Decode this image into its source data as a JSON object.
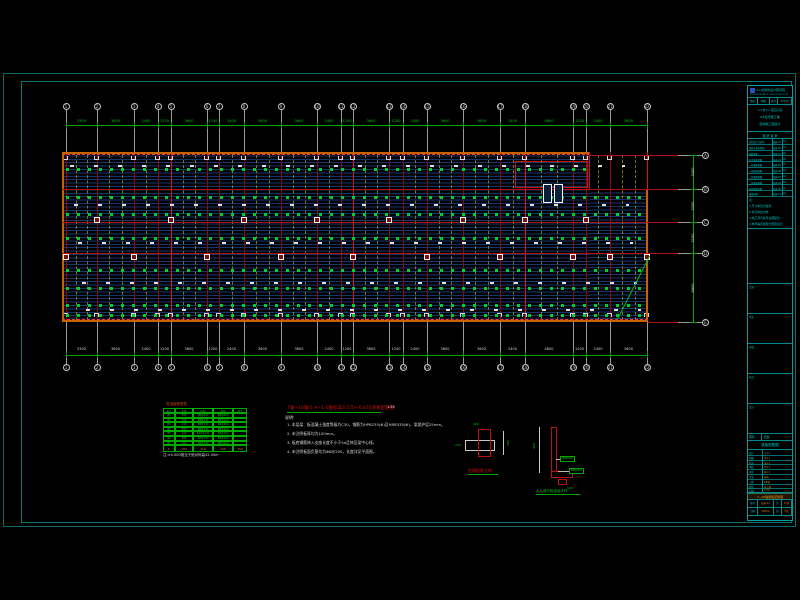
{
  "colors": {
    "background": "#000000",
    "frame_teal": "#0c6868",
    "titleblock_cyan": "#00c8c8",
    "grid_red": "#b01010",
    "bright_red": "#e01414",
    "dim_green": "#00aa00",
    "rebar_green": "#00d028",
    "edge_orange": "#c86400",
    "value_orange": "#d2821e",
    "slab_line": "#16356b",
    "text_white": "#d8d8d8"
  },
  "plan": {
    "grid_labels": [
      "1",
      "2",
      "3",
      "4",
      "5",
      "6",
      "7",
      "8",
      "9",
      "10",
      "11",
      "12",
      "13",
      "14",
      "15",
      "16",
      "17",
      "18",
      "19",
      "20",
      "21",
      "22"
    ],
    "grid_x": [
      66,
      97,
      134,
      158,
      171,
      207,
      219,
      244,
      281,
      317,
      341,
      353,
      389,
      403,
      427,
      463,
      500,
      525,
      573,
      586,
      610,
      647
    ],
    "major_indices": [
      4,
      11,
      17,
      21
    ],
    "dims_top": [
      "3300",
      "3600",
      "2400",
      "1200",
      "3600",
      "1200",
      "2400",
      "3600",
      "3600",
      "2400",
      "1200",
      "3600",
      "1200",
      "2400",
      "3600",
      "3600",
      "2400",
      "4800",
      "1200",
      "2400",
      "3600"
    ],
    "dims_bottom": [
      "3300",
      "3600",
      "2400",
      "1200",
      "3600",
      "1200",
      "2400",
      "3600",
      "3600",
      "2400",
      "1200",
      "3600",
      "1200",
      "2400",
      "3600",
      "3600",
      "2400",
      "4800",
      "1200",
      "2400",
      "3600"
    ],
    "row_labels": [
      "A",
      "B",
      "C",
      "D",
      "E"
    ],
    "row_y": [
      155,
      189,
      222,
      253,
      322
    ],
    "dims_right": [
      "3400",
      "3300",
      "3100",
      "6900"
    ],
    "tick_rows": [
      168,
      196,
      213,
      237,
      269,
      287,
      304,
      314
    ],
    "label_rows": [
      165,
      204,
      242,
      282,
      309
    ],
    "columns_row1": [
      97,
      171,
      244,
      317,
      389,
      463,
      525,
      586
    ],
    "columns_row2": [
      66,
      134,
      207,
      281,
      353,
      427,
      500,
      573,
      610,
      647
    ]
  },
  "schedule": {
    "title": "现浇板配筋表",
    "columns": [
      "板号",
      "板厚",
      "底筋",
      "面筋",
      "备注"
    ],
    "rows": [
      [
        "B1",
        "100",
        "Φ8@150",
        "Φ8@200",
        ""
      ],
      [
        "B2",
        "100",
        "Φ8@140",
        "Φ8@200",
        ""
      ],
      [
        "B3",
        "110",
        "Φ8@130",
        "Φ8@180",
        ""
      ],
      [
        "B4",
        "100",
        "Φ8@150",
        "Φ8@200",
        ""
      ],
      [
        "B5",
        "120",
        "Φ10@150",
        "Φ8@180",
        ""
      ],
      [
        "B6",
        "100",
        "Φ8@150",
        "Φ8@200",
        ""
      ],
      [
        "B7",
        "100",
        "Φ8@140",
        "Φ8@200",
        ""
      ]
    ],
    "footer": [
      "h",
      "100",
      "110",
      "120",
      "150"
    ],
    "note": "注:±0.000相当于绝对标高42.50m"
  },
  "notes": {
    "title": "7轴~16轴/1-A~1-E轴标高3.570~6.870梁板配筋图",
    "scale": "1:50",
    "heading": "说明:",
    "items": [
      "1. 本层梁、板混凝土强度等级为C30，钢筋为HPB235(Φ)及HRB335(Φ)，梁保护层25mm。",
      "2. 未注明板厚均为100mm。",
      "3. 板底钢筋伸入支座长度不小于5d且伸至梁中心线。",
      "4. 未注明板面负筋均为Φ8@200，长度详见平面图。"
    ]
  },
  "details": {
    "left": {
      "caption": "柱帽配筋大样",
      "dim_top": "400",
      "dim_left": "150",
      "dim_right": "300"
    },
    "right": {
      "caption": "女儿墙与板连接大样",
      "dim_height": "600",
      "tag1": "Φ8@200",
      "tag2": "Φ8@200",
      "dim_base": "120"
    }
  },
  "titleblock": {
    "company": "××省建筑设计研究院",
    "company_en": "PROVINCIAL ARCH. DESIGN INSTITUTE",
    "cert": [
      "资质",
      "甲级",
      "编号",
      "A0123"
    ],
    "project_lines": [
      "××市××花园小区",
      "6#住宅楼工程",
      "结构施工图设计"
    ],
    "list_title": "图 纸 目 录",
    "list_rows": [
      [
        "结构设计总说明",
        "结施-01",
        "A2"
      ],
      [
        "基础平面布置图",
        "结施-02",
        "A2"
      ],
      [
        "基础详图",
        "结施-03",
        "A2"
      ],
      [
        "柱平面布置图",
        "结施-04",
        "A2"
      ],
      [
        "一层梁配筋图",
        "结施-05",
        "A2"
      ],
      [
        "一层板配筋图",
        "结施-06",
        "A2"
      ],
      [
        "二层梁配筋图",
        "结施-07",
        "A2"
      ],
      [
        "二层板配筋图",
        "结施-08",
        "A2"
      ],
      [
        "屋面梁配筋图",
        "结施-09",
        "A2"
      ],
      [
        "楼梯详图",
        "结施-10",
        "A2"
      ]
    ],
    "note_lines": [
      "注:",
      "1.尺寸单位为毫米;",
      "2.标高单位为米;",
      "3.施工须与各专业图配合;",
      "4.未尽事宜按现行规范执行。"
    ],
    "sign_labels": [
      "会签",
      "审定",
      "审核",
      "校对",
      "设计"
    ],
    "bottom": {
      "class_label": "图别",
      "class_value": "结施",
      "sheet_name": "梁板配筋图",
      "rows": [
        [
          "设计",
          "王××"
        ],
        [
          "制图",
          "李××"
        ],
        [
          "校对",
          "张××"
        ],
        [
          "审核",
          "刘××"
        ],
        [
          "审定",
          "陈××"
        ],
        [
          "专业",
          "结构"
        ],
        [
          "工程",
          "6#楼"
        ],
        [
          "阶段",
          "施工图"
        ],
        [
          "比例",
          "1:50"
        ]
      ],
      "highlight": "7~16轴梁板配筋图",
      "footer1": [
        "图号",
        "结施-12",
        "共",
        "12张"
      ],
      "footer2": [
        "日期",
        "2008.6",
        "第",
        "5张"
      ]
    }
  }
}
